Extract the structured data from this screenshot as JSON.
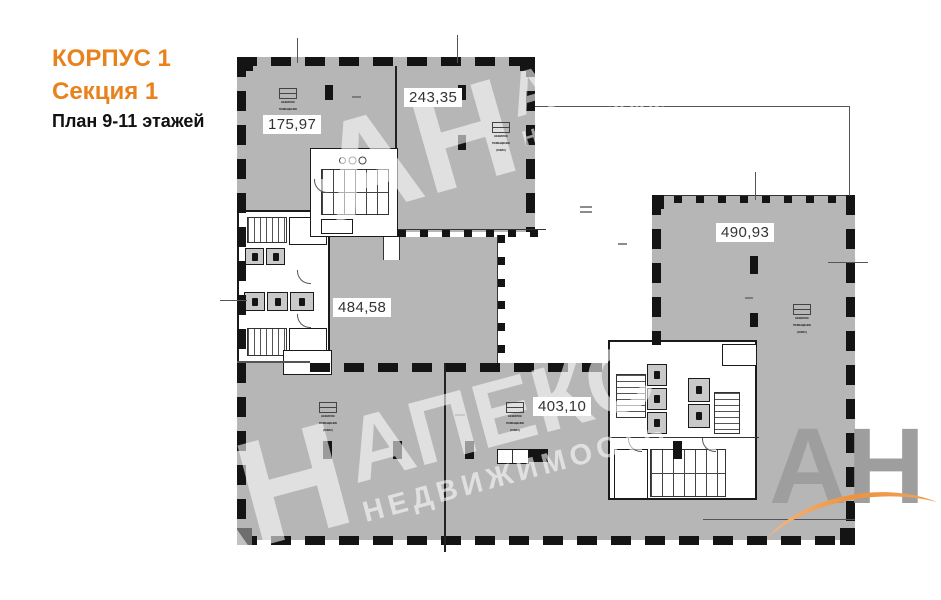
{
  "header": {
    "building": "КОРПУС 1",
    "section": "Секция 1",
    "floors": "План 9-11 этажей"
  },
  "area_labels": [
    {
      "value": "175,97"
    },
    {
      "value": "243,35"
    },
    {
      "value": "484,58"
    },
    {
      "value": "490,93"
    },
    {
      "value": "403,10"
    }
  ],
  "stamp": {
    "lines": [
      "НЕЖИЛОЕ",
      "ПОМЕЩЕНИЕ",
      "(ОФИС)"
    ]
  },
  "watermark": {
    "abbr": "АН",
    "name": "АПЕКС",
    "subtitle": "НЕДВИЖИМОСТЬ"
  },
  "logo": {
    "text": "АН"
  },
  "colors": {
    "accent_orange": "#e8821d",
    "floor_gray": "#b6b6b6",
    "wall_black": "#141414",
    "logo_gray": "#9e9e9e",
    "swoosh_orange": "#ea8c34"
  }
}
